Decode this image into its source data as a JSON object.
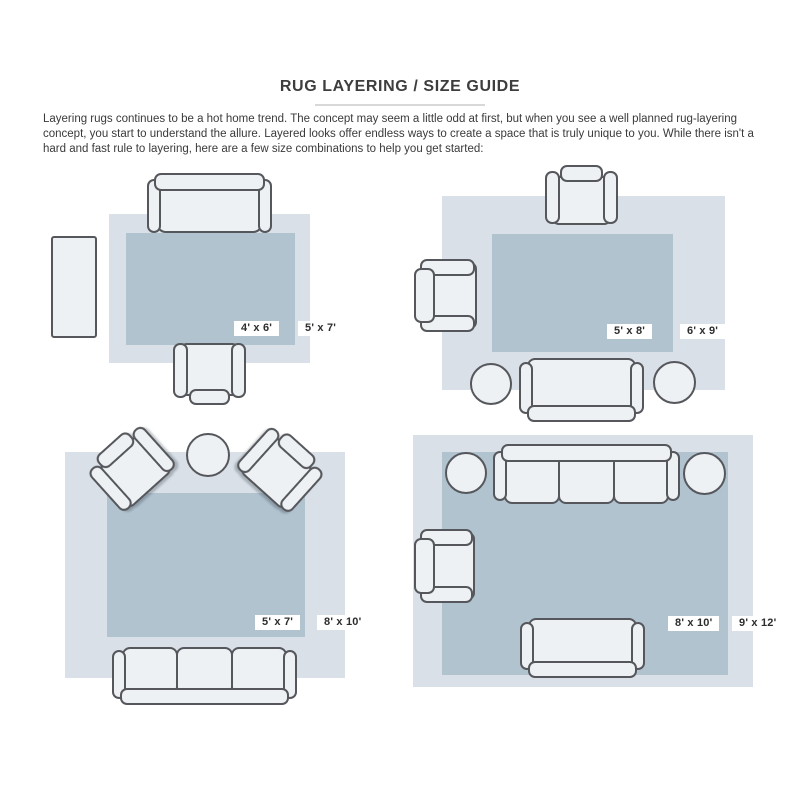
{
  "header": {
    "title": "RUG LAYERING / SIZE GUIDE",
    "intro": "Layering rugs continues to be a hot home trend. The concept may seem a little odd at first, but when you see a well planned rug-layering concept, you start to understand the allure. Layered looks offer endless ways to create a space that is truly unique to you. While there isn't a hard and fast rule to layering, here are a few size combinations to help you get started:"
  },
  "colors": {
    "outer_rug": "#d9e0e7",
    "inner_rug": "#b1c3cf",
    "furniture_fill": "#eef1f3",
    "furniture_stroke": "#55575c",
    "label_text": "#2d2d2d",
    "title_color": "#3d3d3d",
    "body_color": "#3a3a3a",
    "divider_color": "#d8d8d8"
  },
  "diagrams": [
    {
      "name": "sofa with side table and armchair",
      "inner_label": "4' x 6'",
      "outer_label": "5' x 7'",
      "furniture": [
        "sofa",
        "side-table",
        "armchair"
      ]
    },
    {
      "name": "sofa with two armchairs and two round ottomans",
      "inner_label": "5' x 8'",
      "outer_label": "6' x 9'",
      "furniture": [
        "armchair",
        "armchair",
        "loveseat",
        "round-ottoman",
        "round-ottoman"
      ]
    },
    {
      "name": "three-seat sofa with two angled armchairs and round table",
      "inner_label": "5' x 7'",
      "outer_label": "8' x 10'",
      "furniture": [
        "armchair",
        "armchair",
        "round-table",
        "three-seat-sofa"
      ]
    },
    {
      "name": "three-seat sofa with loveseat, armchair and two round ottomans",
      "inner_label": "8' x 10'",
      "outer_label": "9' x 12'",
      "furniture": [
        "three-seat-sofa",
        "round-ottoman",
        "round-ottoman",
        "armchair",
        "loveseat"
      ]
    }
  ]
}
